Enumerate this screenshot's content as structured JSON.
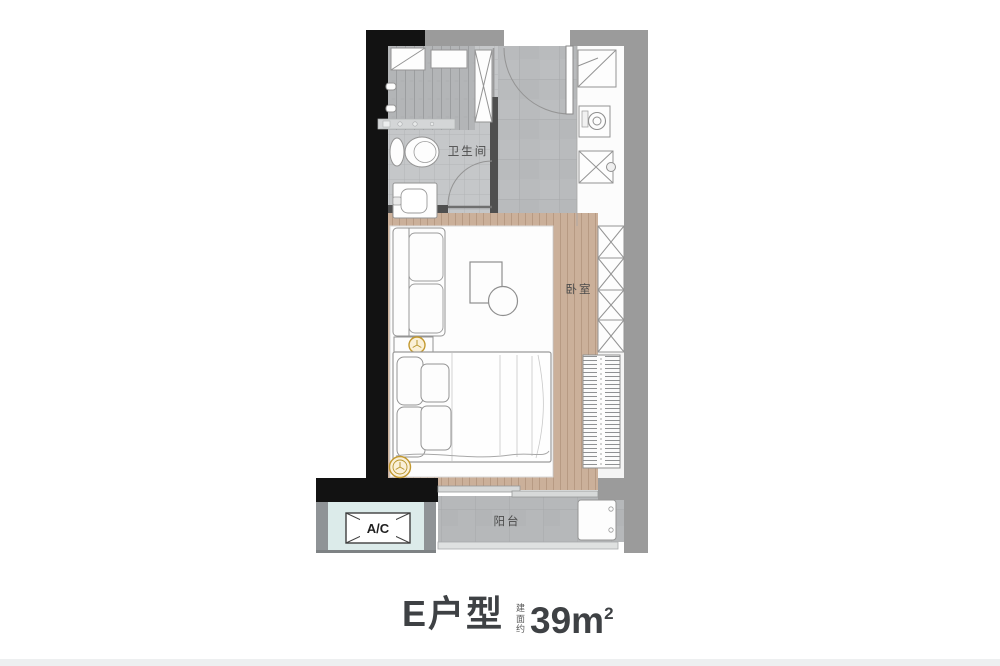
{
  "colors": {
    "wall-black": "#121212",
    "wall-gray": "#9b9b9b",
    "wall-dark": "#4f4f4f",
    "wood": "#cbb09a",
    "tile": "#bcbec0",
    "ac-blue": "#dcebea",
    "gold": "#c3992f",
    "label-text": "#4b4b4b",
    "title-text": "#3e4144"
  },
  "plan": {
    "labels": {
      "bathroom": "卫生间",
      "bedroom": "卧室",
      "balcony": "阳台",
      "ac": "A/C"
    }
  },
  "title": {
    "name": "E户型",
    "area_prefix": "建面约",
    "area_value": "39",
    "area_unit": "m",
    "area_sup": "2"
  }
}
